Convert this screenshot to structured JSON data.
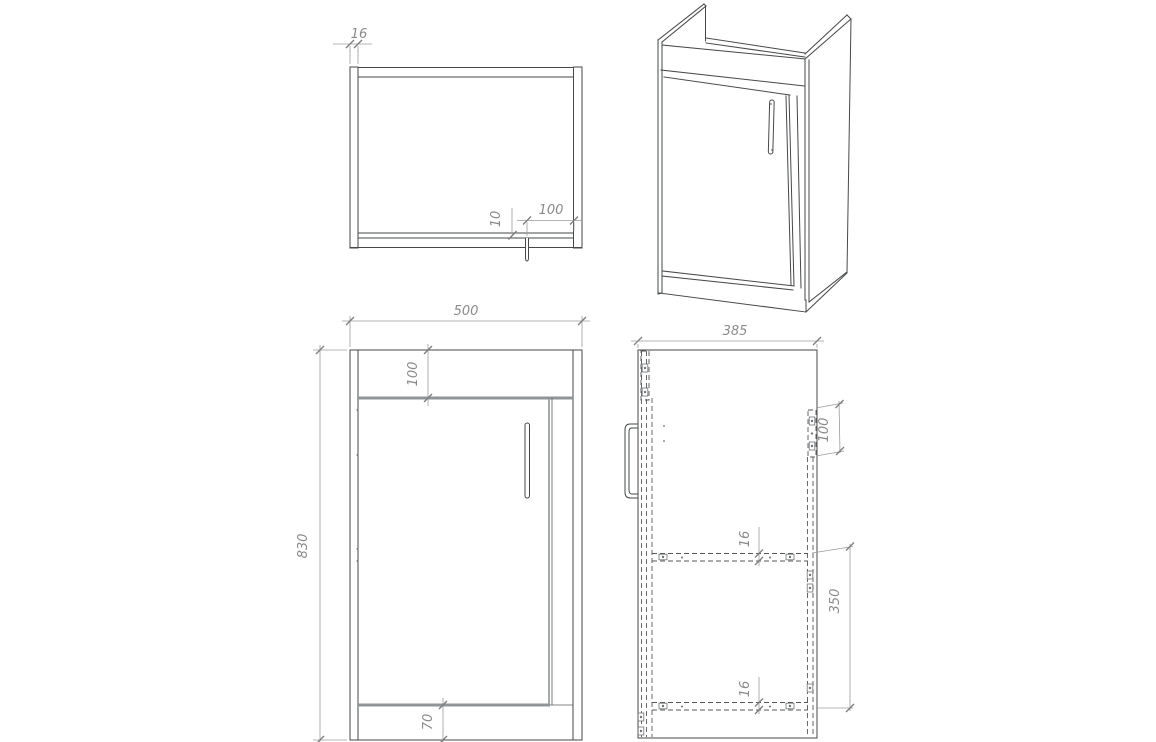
{
  "drawing": {
    "top_view": {
      "dim_side_panel_thickness": "16",
      "dim_door_reveal": "10",
      "dim_handle_offset": "100"
    },
    "front_view": {
      "dim_overall_width": "500",
      "dim_top_rail_height": "100",
      "dim_overall_height": "830",
      "dim_plinth_height": "70"
    },
    "side_view": {
      "dim_overall_depth": "385",
      "dim_back_rail_height": "100",
      "dim_shelf_thickness": "16",
      "dim_shelf_spacing": "350",
      "dim_bottom_panel_thickness": "16"
    },
    "line_color": "#46484a",
    "dimension_color": "#8a8a8a",
    "hidden_line_color": "#55575a",
    "door_edge_color": "#8f9496"
  }
}
